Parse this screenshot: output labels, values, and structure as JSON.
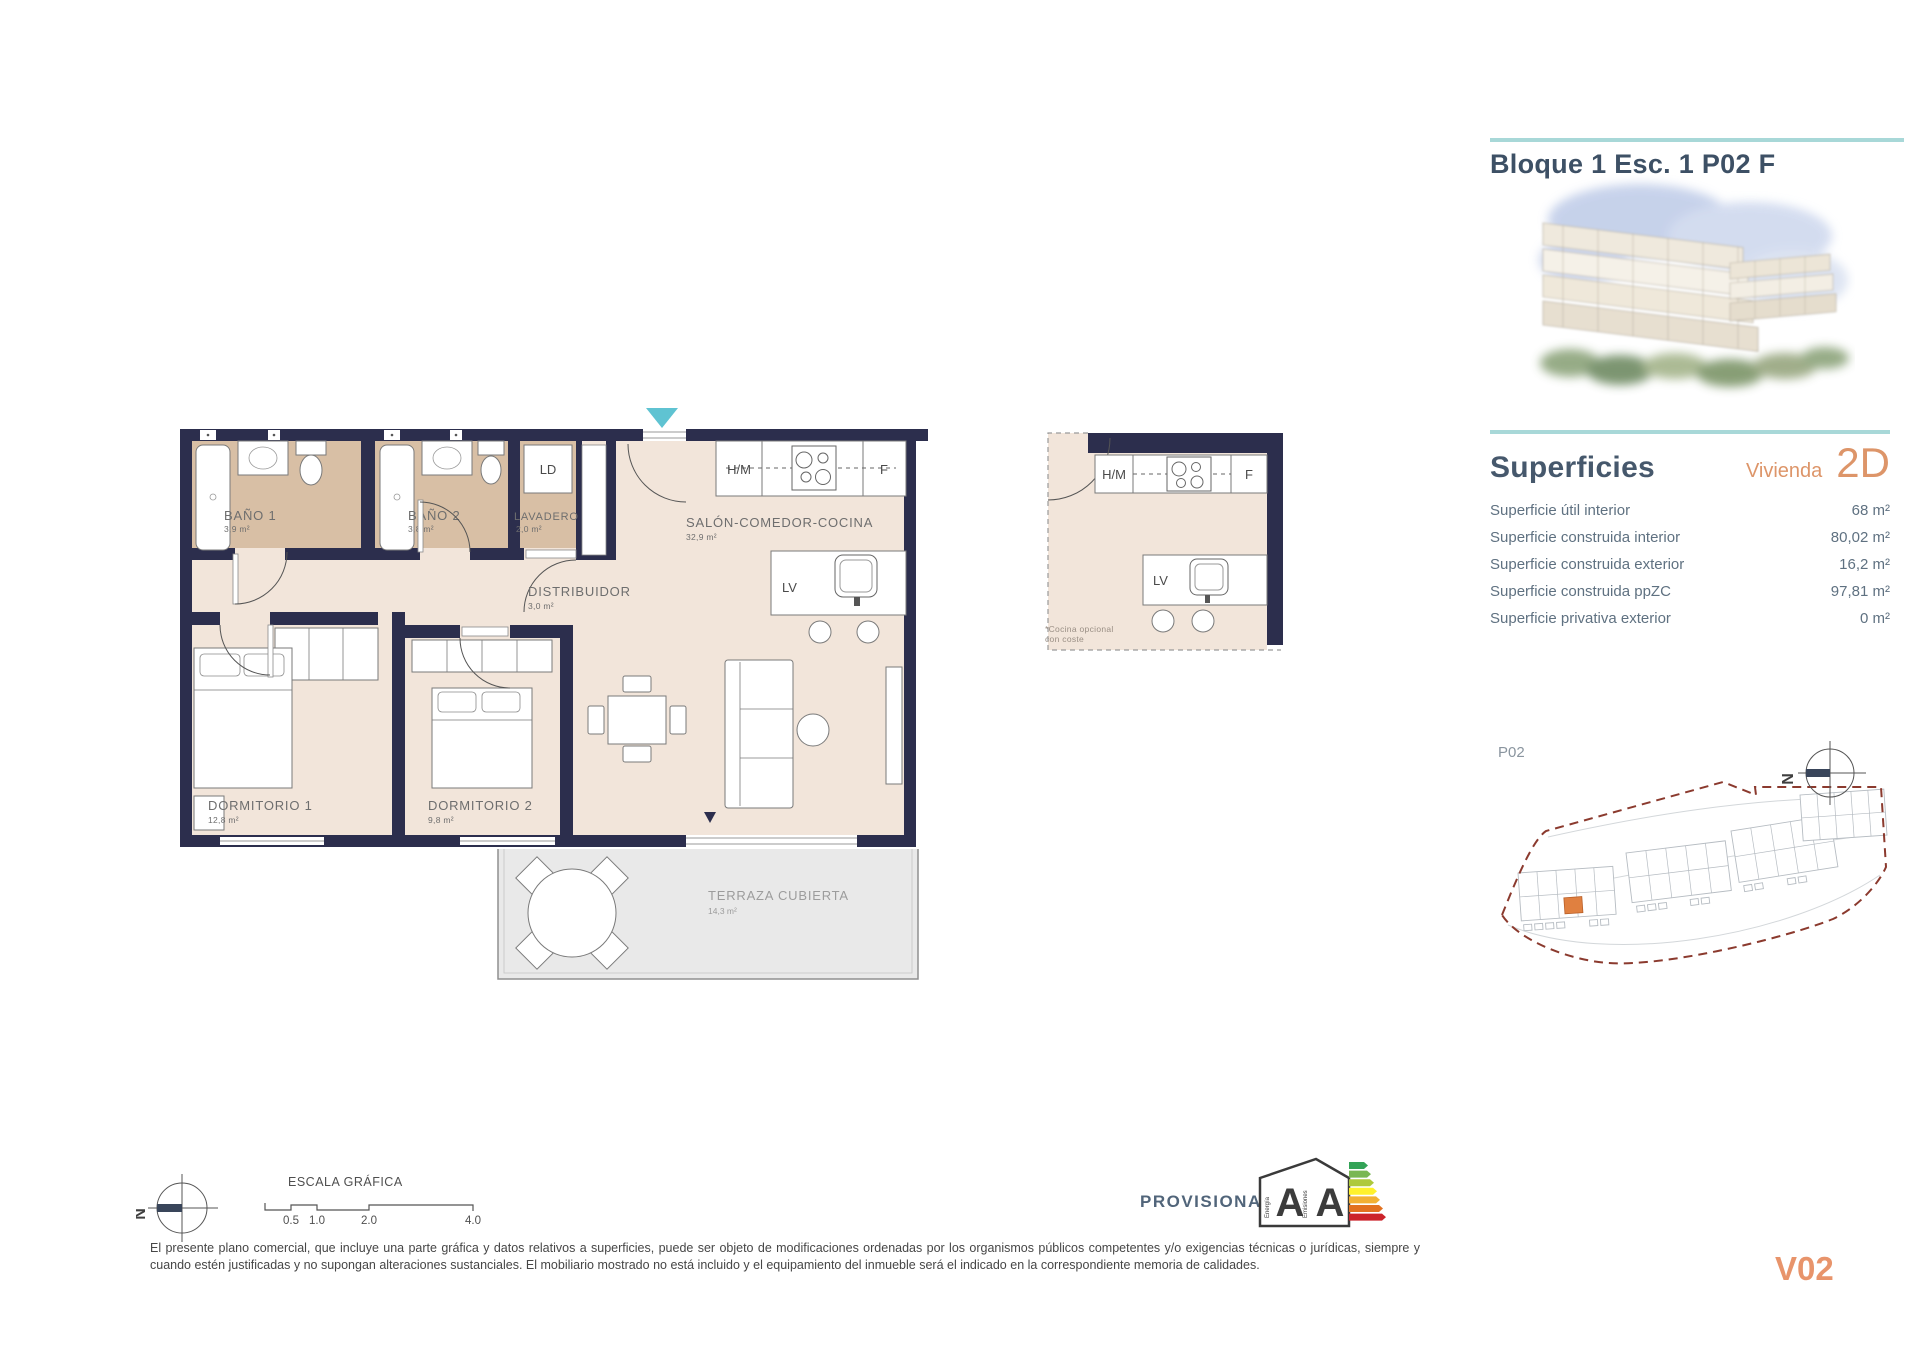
{
  "header": {
    "title": "Bloque 1 Esc. 1 P02 F"
  },
  "superficies": {
    "heading": "Superficies",
    "vivienda_label": "Vivienda",
    "vivienda_code": "2D",
    "rows": [
      {
        "label": "Superficie útil interior",
        "value": "68 m²"
      },
      {
        "label": "Superficie construida interior",
        "value": "80,02 m²"
      },
      {
        "label": "Superficie construida exterior",
        "value": "16,2 m²"
      },
      {
        "label": "Superficie construida ppZC",
        "value": "97,81 m²"
      },
      {
        "label": "Superficie privativa exterior",
        "value": "0 m²"
      }
    ]
  },
  "floorplan": {
    "rooms": [
      {
        "name": "BAÑO 1",
        "area": "3,9 m²"
      },
      {
        "name": "BAÑO 2",
        "area": "3,8 m²"
      },
      {
        "name": "LAVADERO",
        "area": "2,0 m²"
      },
      {
        "name": "DISTRIBUIDOR",
        "area": "3,0 m²"
      },
      {
        "name": "SALÓN-COMEDOR-COCINA",
        "area": "32,9 m²"
      },
      {
        "name": "DORMITORIO 1",
        "area": "12,8 m²"
      },
      {
        "name": "DORMITORIO 2",
        "area": "9,8 m²"
      },
      {
        "name": "TERRAZA CUBIERTA",
        "area": "14,3 m²"
      }
    ],
    "fixtures": {
      "ld": "LD",
      "hm": "H/M",
      "f": "F",
      "lv": "LV"
    },
    "kitchen_note_line1": "*Cocina opcional",
    "kitchen_note_line2": "con coste"
  },
  "siteplan": {
    "label": "P02"
  },
  "compass": {
    "north": "N"
  },
  "footer": {
    "scale_title": "ESCALA GRÁFICA",
    "scale_ticks": [
      "0.5",
      "1.0",
      "2.0",
      "4.0"
    ],
    "provisional": "PROVISIONAL",
    "energy": {
      "energy_letter": "A",
      "emissions_letter": "A",
      "energy_word": "Energía",
      "emissions_word": "Emisiones"
    },
    "disclaimer": "El presente plano comercial, que incluye una parte gráfica y datos relativos a superficies, puede ser objeto de modificaciones ordenadas por los organismos públicos competentes y/o exigencias técnicas o jurídicas, siempre y cuando estén justificadas y no supongan alteraciones sustanciales. El mobiliario mostrado no está incluido y el equipamiento del inmueble será el indicado en la correspondiente memoria de calidades.",
    "version": "V02"
  },
  "colors": {
    "wall_navy": "#2c2e4d",
    "floor_cream": "#f2e5da",
    "floor_tan": "#d8bfa5",
    "terrace_gray": "#e9e9e9",
    "accent_teal": "#a8d8d8",
    "entrance_arrow_teal": "#5fc3d2",
    "accent_orange": "#dd9569",
    "site_boundary_red": "#8b3a2e"
  }
}
